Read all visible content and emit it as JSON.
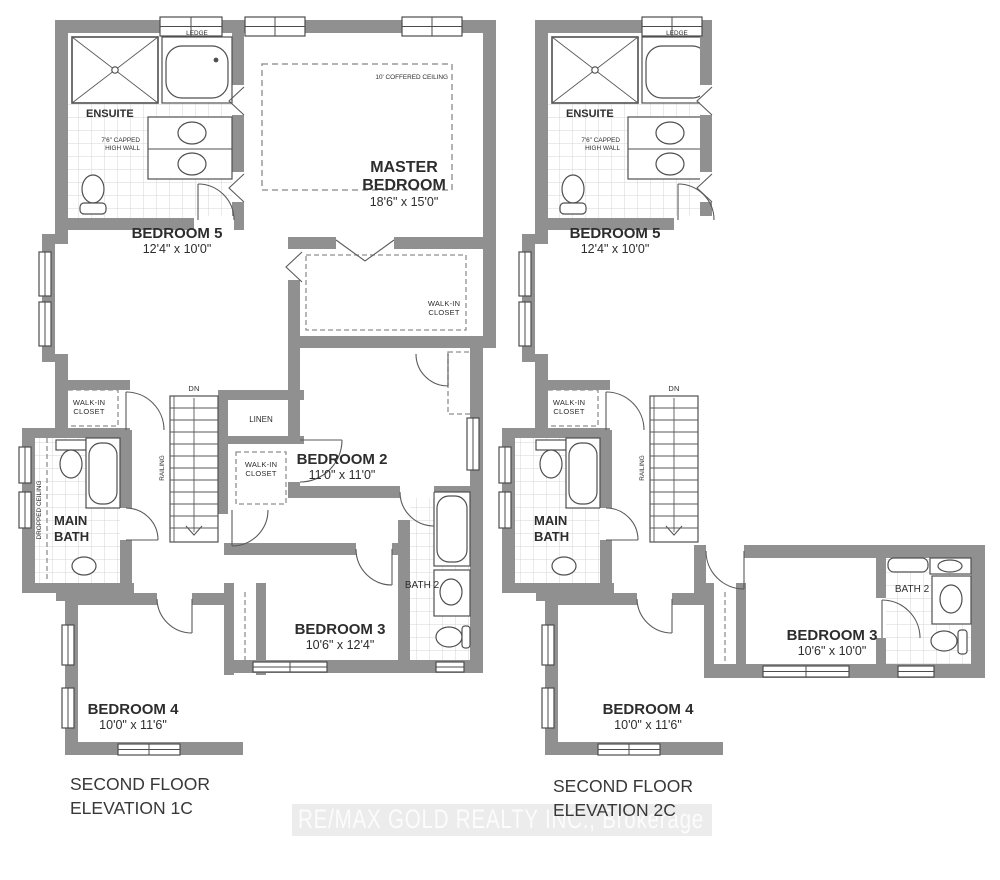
{
  "watermark_text": "RE/MAX GOLD REALTY INC., Brokerage",
  "colors": {
    "wall": "#909090",
    "text": "#2d2d2d",
    "tile_line": "#d6d6d6",
    "watermark_band": "#eaeaea",
    "watermark_text": "#fcfcfc"
  },
  "plan_1c": {
    "title_line1": "SECOND FLOOR",
    "title_line2": "ELEVATION 1C",
    "labels": {
      "ledge": "LEDGE",
      "ensuite": "ENSUITE",
      "capped_wall_line1": "7'6\" CAPPED",
      "capped_wall_line2": "HIGH WALL",
      "coffered_ceiling": "10' COFFERED CEILING",
      "master_line1": "MASTER",
      "master_line2": "BEDROOM",
      "master_dims": "18'6\" x 15'0\"",
      "bedroom5": "BEDROOM 5",
      "bedroom5_dims": "12'4\" x 10'0\"",
      "master_closet_line1": "WALK-IN",
      "master_closet_line2": "CLOSET",
      "dn": "DN",
      "railing": "RAILING",
      "linen": "LINEN",
      "closet2_line1": "WALK-IN",
      "closet2_line2": "CLOSET",
      "closet5_line1": "WALK-IN",
      "closet5_line2": "CLOSET",
      "dropped_ceiling": "DROPPED CEILING",
      "main_bath_line1": "MAIN",
      "main_bath_line2": "BATH",
      "bedroom2": "BEDROOM 2",
      "bedroom2_dims": "11'0\" x 11'0\"",
      "bedroom3": "BEDROOM 3",
      "bedroom3_dims": "10'6\" x 12'4\"",
      "bath2": "BATH 2",
      "bedroom4": "BEDROOM 4",
      "bedroom4_dims": "10'0\" x 11'6\""
    }
  },
  "plan_2c": {
    "title_line1": "SECOND FLOOR",
    "title_line2": "ELEVATION  2C",
    "labels": {
      "ledge": "LEDGE",
      "ensuite": "ENSUITE",
      "capped_wall_line1": "7'6\" CAPPED",
      "capped_wall_line2": "HIGH WALL",
      "bedroom5": "BEDROOM 5",
      "bedroom5_dims": "12'4\" x 10'0\"",
      "closet5_line1": "WALK-IN",
      "closet5_line2": "CLOSET",
      "dn": "DN",
      "railing": "RAILING",
      "main_bath_line1": "MAIN",
      "main_bath_line2": "BATH",
      "bedroom4": "BEDROOM 4",
      "bedroom4_dims": "10'0\" x 11'6\"",
      "bedroom3": "BEDROOM 3",
      "bedroom3_dims": "10'6\" x 10'0\"",
      "bath2": "BATH 2"
    }
  }
}
